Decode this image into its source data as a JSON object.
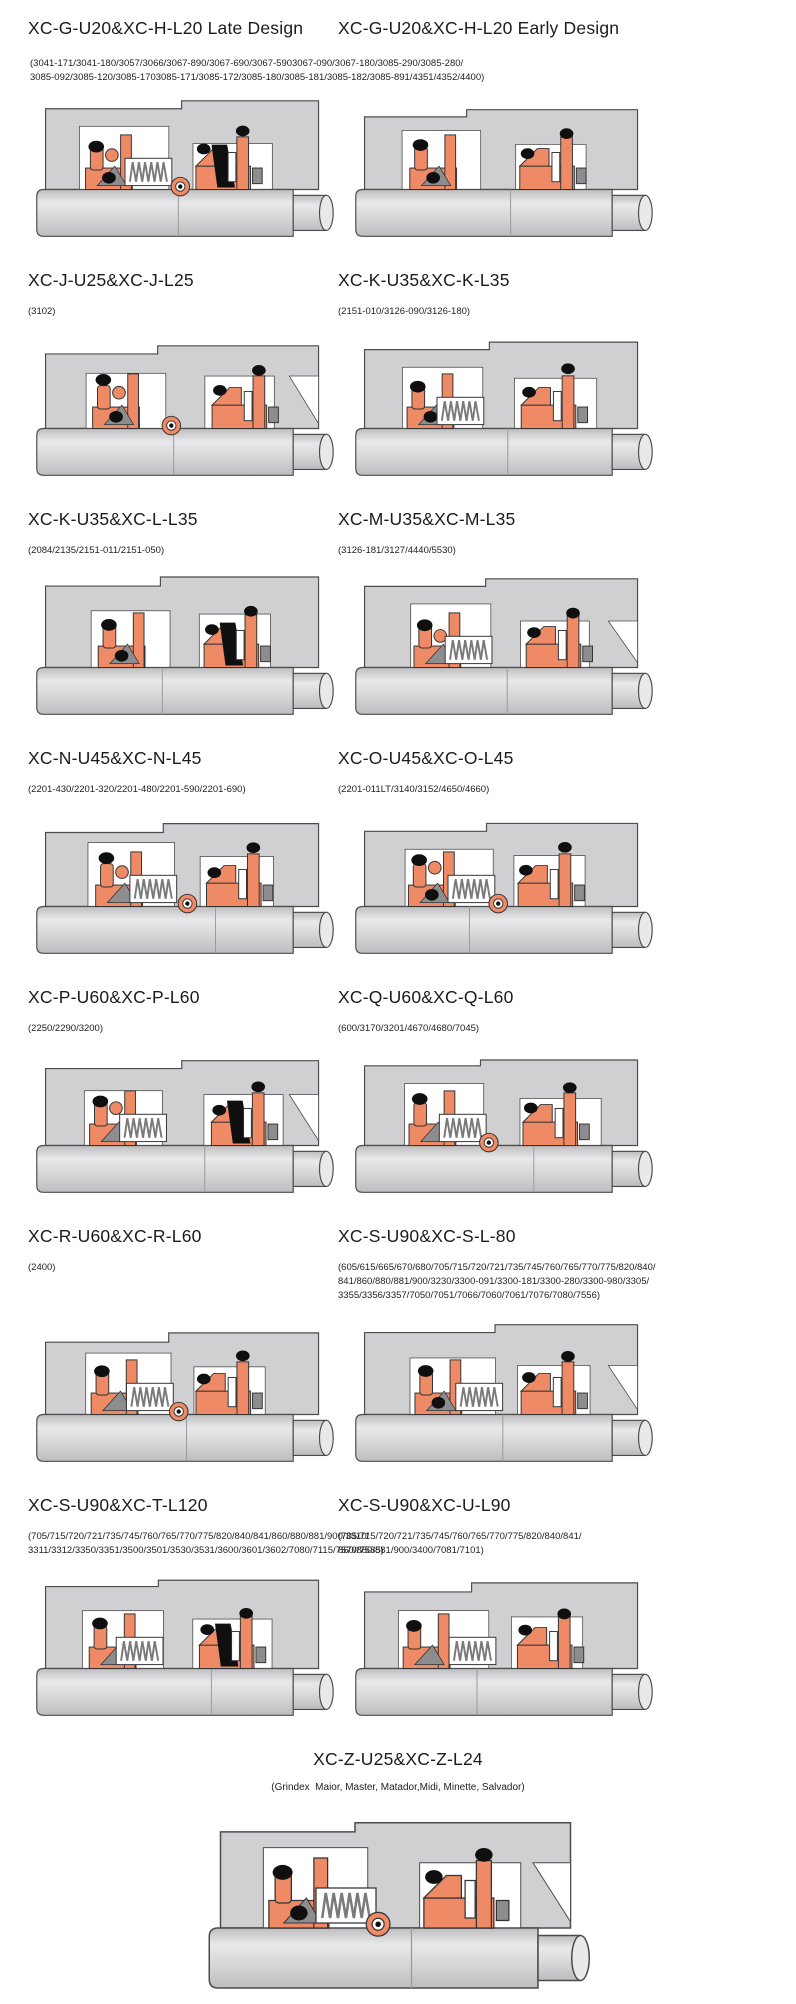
{
  "colors": {
    "accent": "#ee8a65",
    "housing": "#d0d0d2",
    "shaft_light": "#e9e9eb",
    "shaft_dark": "#bdbdbf",
    "elastomer": "#0f0f0f",
    "hardware": "#8d8d8f",
    "outline": "#4b4b4b",
    "background": "#ffffff"
  },
  "rows": [
    {
      "left": {
        "title": "XC-G-U20&XC-H-L20 Late Design"
      },
      "right": {
        "title": "XC-G-U20&XC-H-L20 Early Design"
      },
      "shared_models": [
        "(3041-171/3041-180/3057/3066/3067-890/3067-690/3067-5903067-090/3067-180/3085-290/3085-280/",
        "3085-092/3085-120/3085-1703085-171/3085-172/3085-180/3085-181/3085-182/3085-891/4351/4352/4400)"
      ]
    },
    {
      "left": {
        "title": "XC-J-U25&XC-J-L25",
        "models": [
          "(3102)"
        ]
      },
      "right": {
        "title": "XC-K-U35&XC-K-L35",
        "models": [
          "(2151-010/3126-090/3126-180)"
        ]
      }
    },
    {
      "left": {
        "title": "XC-K-U35&XC-L-L35",
        "models": [
          "(2084/2135/2151-011/2151-050)"
        ]
      },
      "right": {
        "title": "XC-M-U35&XC-M-L35",
        "models": [
          "(3126-181/3127/4440/5530)"
        ]
      }
    },
    {
      "left": {
        "title": "XC-N-U45&XC-N-L45",
        "models": [
          "(2201-430/2201-320/2201-480/2201-590/2201-690)"
        ]
      },
      "right": {
        "title": "XC-O-U45&XC-O-L45",
        "models": [
          "(2201-011LT/3140/3152/4650/4660)"
        ]
      }
    },
    {
      "left": {
        "title": "XC-P-U60&XC-P-L60",
        "models": [
          "(2250/2290/3200)"
        ]
      },
      "right": {
        "title": "XC-Q-U60&XC-Q-L60",
        "models": [
          "(600/3170/3201/4670/4680/7045)"
        ]
      }
    },
    {
      "left": {
        "title": "XC-R-U60&XC-R-L60",
        "models": [
          "(2400)"
        ]
      },
      "right": {
        "title": "XC-S-U90&XC-S-L-80",
        "models": [
          "(605/615/665/670/680/705/715/720/721/735/745/760/765/770/775/820/840/",
          "841/860/880/881/900/3230/3300-091/3300-181/3300-280/3300-980/3305/",
          "3355/3356/3357/7050/7051/7066/7060/7061/7076/7080/7556)"
        ]
      }
    },
    {
      "left": {
        "title": "XC-S-U90&XC-T-L120",
        "models": [
          "(705/715/720/721/735/745/760/765/770/775/820/840/841/860/880/881/900/3310/",
          "3311/3312/3350/3351/3500/3501/3530/3531/3600/3601/3602/7080/7115/7570/7585)"
        ]
      },
      "right": {
        "title": "XC-S-U90&XC-U-L90",
        "models": [
          "(705/715/720/721/735/745/760/765/770/775/820/840/841/",
          "860/880/881/900/3400/7081/7101)"
        ]
      }
    }
  ],
  "footer": {
    "title": "XC-Z-U25&XC-Z-L24",
    "models": [
      "(Grindex  Maior, Master, Matador,Midi, Minette, Salvador)"
    ]
  }
}
